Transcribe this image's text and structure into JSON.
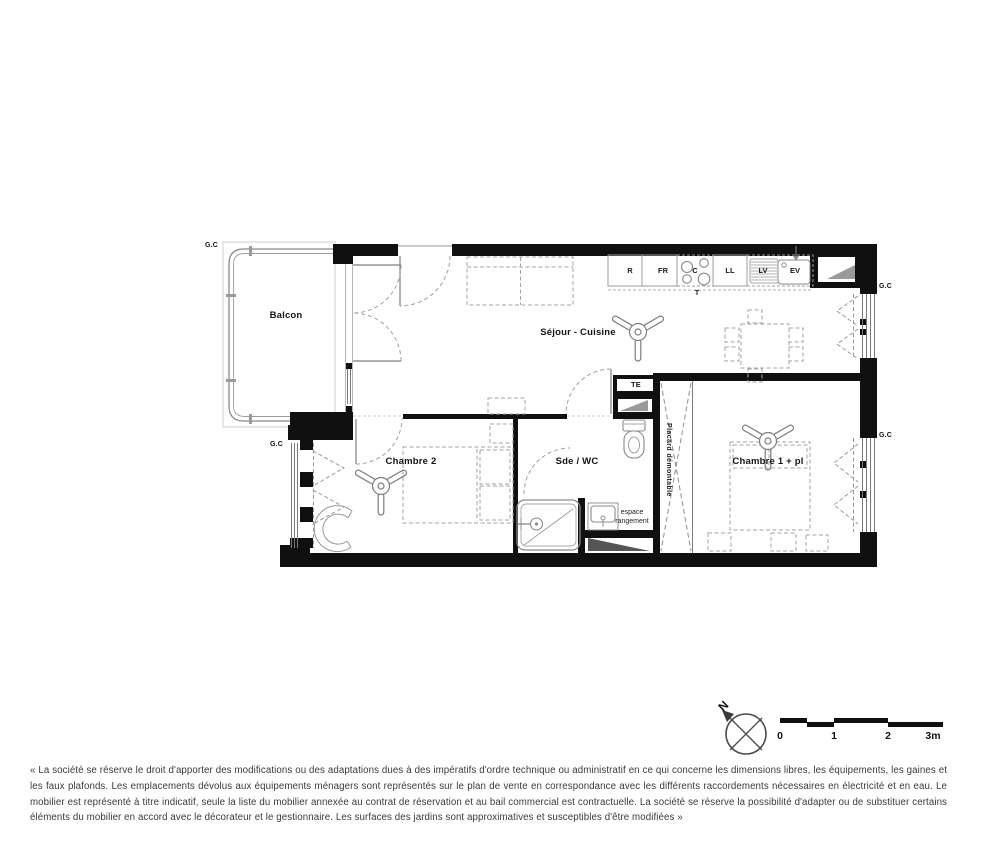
{
  "plan": {
    "rooms": {
      "balcony": "Balcon",
      "living_kitchen": "Séjour - Cuisine",
      "bedroom2": "Chambre 2",
      "shower_wc": "Sde / WC",
      "bedroom1": "Chambre 1 + pl"
    },
    "labels": {
      "guard_rail": "G.C",
      "technical_duct": "TE",
      "removable_closet": "Placard démontable",
      "storage_space": "espace rangement"
    },
    "kitchen": {
      "fridge": "R",
      "freezer": "FR",
      "cooktop": "C",
      "cooktop_sub": "T",
      "washing_machine": "LL",
      "dishwasher": "LV",
      "sink": "EV"
    }
  },
  "compass": {
    "north": "N"
  },
  "scale_bar": {
    "ticks": [
      "0",
      "1",
      "2",
      "3m"
    ]
  },
  "disclaimer": "« La société se réserve le droit d'apporter des modifications ou des adaptations dues à des impératifs d'ordre technique ou administratif en ce qui concerne les dimensions libres, les équipements, les gaines et les faux plafonds. Les emplacements dévolus aux équipements ménagers sont représentés sur le plan de vente en correspondance avec les différents raccordements nécessaires en électricité et en eau. Le mobilier est représenté à titre indicatif, seule la liste du mobilier annexée au contrat de réservation et au bail commercial est contractuelle. La société se réserve la possibilité d'adapter ou de substituer certains éléments du mobilier en accord avec le décorateur et le gestionnaire. Les surfaces des jardins sont approximatives et susceptibles d'être modifiées »"
}
